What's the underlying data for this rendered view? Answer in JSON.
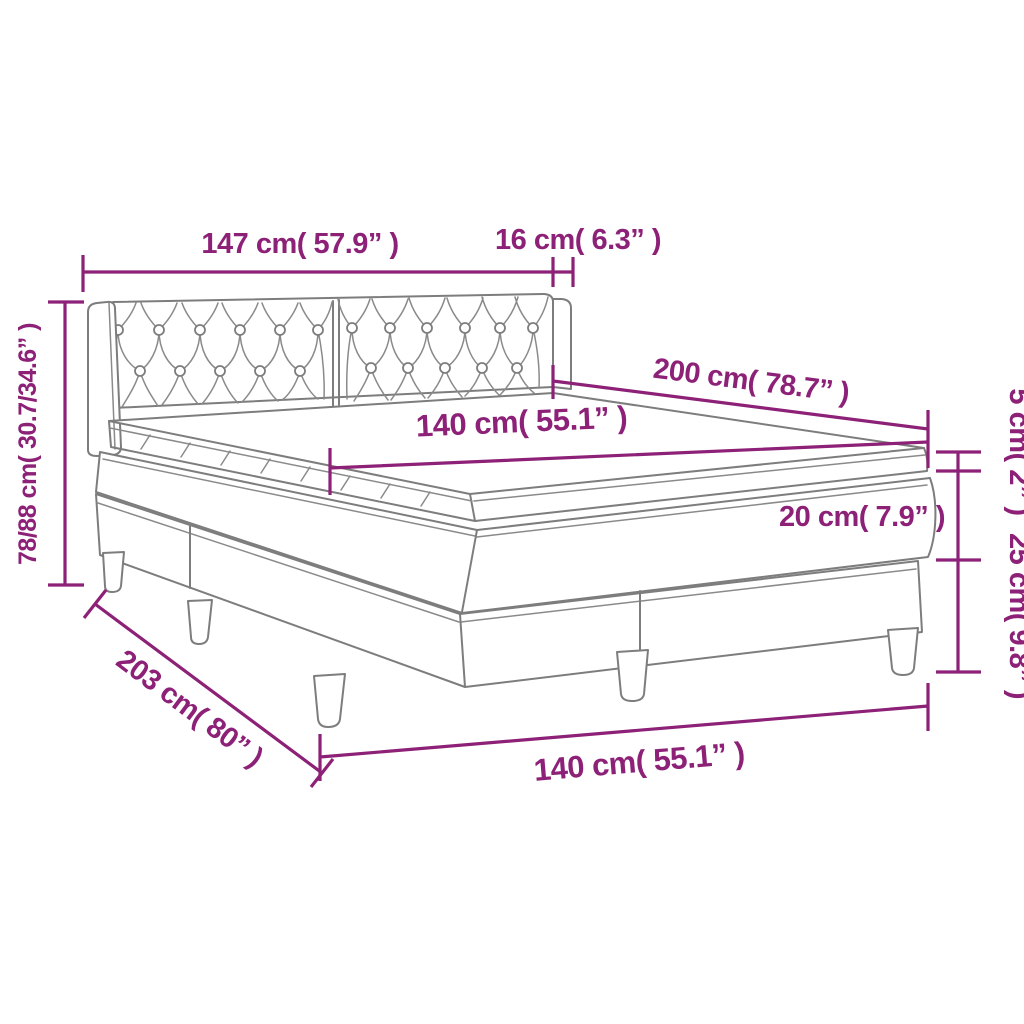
{
  "title": "Box spring bed with tufted headboard - dimension diagram",
  "colors": {
    "dimension": "#8d2077",
    "drawing_gray": "#7d7d7d",
    "background": "#ffffff"
  },
  "labels": {
    "headboard_width": "147 cm( 57.9” )",
    "headboard_depth": "16 cm( 6.3” )",
    "total_height": "78/88 cm( 30.7/34.6” )",
    "bed_length": "200 cm( 78.7” )",
    "mattress_width": "140 cm( 55.1” )",
    "topper_height": "5 cm( 2” )",
    "mattress_height": "20 cm( 7.9” )",
    "base_height": "25 cm( 9.8” )",
    "total_length": "203 cm( 80” )",
    "mattress_width_bottom": "140 cm( 55.1” )"
  }
}
